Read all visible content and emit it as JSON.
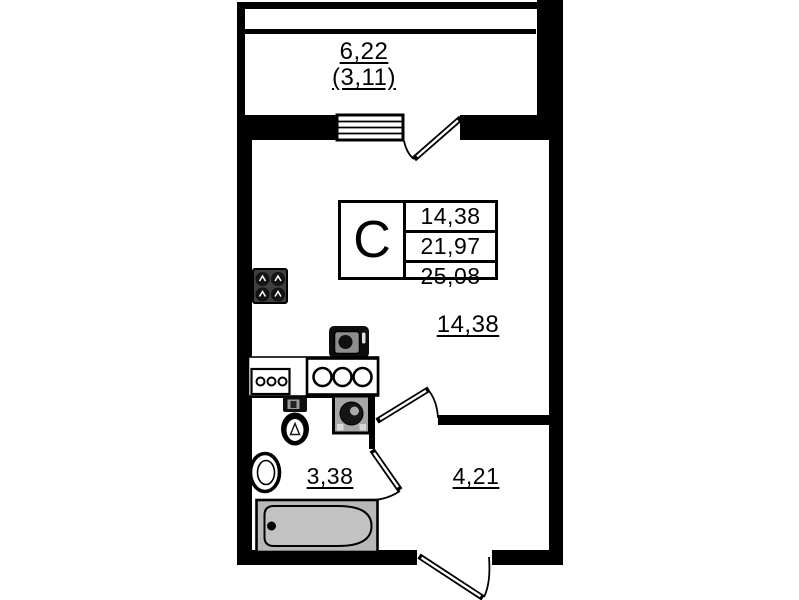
{
  "labels": {
    "balcony_area": "6,22",
    "balcony_area_coeff": "(3,11)",
    "room_area": "14,38",
    "bathroom_area": "3,38",
    "hallway_area": "4,21"
  },
  "info_table": {
    "type": "С",
    "rows": [
      "14,38",
      "21,97",
      "25,08"
    ]
  },
  "colors": {
    "wall": "#000000",
    "stove": "#3f3f3f",
    "appliance": "#a6a6a6",
    "tub": "#b8b8b8",
    "tub_inner": "#c2c2c2"
  },
  "icons": {
    "stove-icon": "square with 4 burner rings",
    "kitchen-sink-icon": "dark block with round basin",
    "cooktop-icon": "box with 3 rings",
    "counter-icon": "outlined worktop box",
    "toilet-icon": "cistern and bowl",
    "washing-machine-icon": "square with drum circle",
    "bath-sink-icon": "round wall basin",
    "bathtub-icon": "rounded tub in gray surround",
    "window-icon": "hatched sill band",
    "door-icon": "leaf with quarter swing arc"
  }
}
